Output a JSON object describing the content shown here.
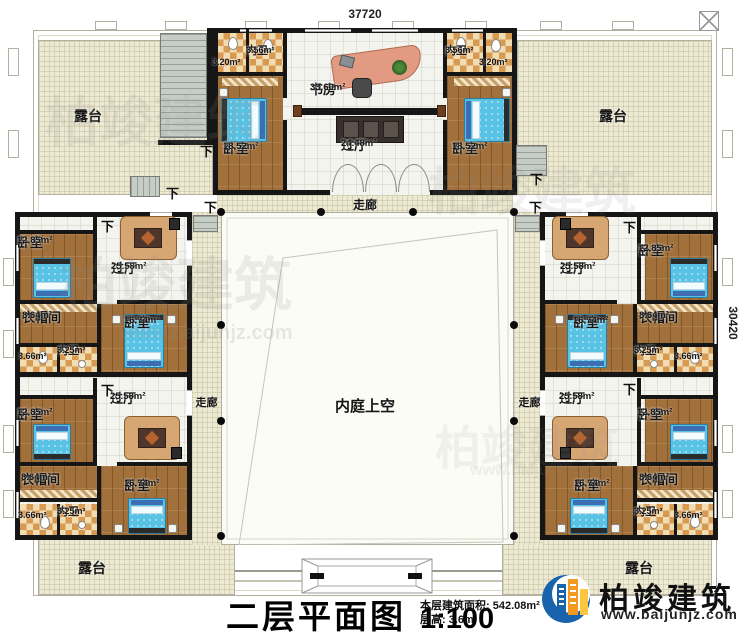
{
  "dimensions": {
    "top": "37720",
    "right": "30420"
  },
  "title": {
    "name": "二层平面图",
    "scale": "1:100",
    "area_info": "本层建筑面积: 542.08m²",
    "floor_height": "层高: 3.6m"
  },
  "logo": {
    "name": "柏竣建筑",
    "url": "www.baijunjz.com"
  },
  "watermark": {
    "text": "柏竣建筑",
    "url": "www.baijunjz.com"
  },
  "courtyard": {
    "label": "内庭上空"
  },
  "corridor": {
    "label": "走廊"
  },
  "terrace": {
    "label": "露台"
  },
  "down_label": "下",
  "top_block": {
    "study": {
      "name": "书房",
      "area": "33.60m²"
    },
    "hall": {
      "name": "过厅",
      "area": "24.48m²"
    },
    "bedroom": {
      "name": "卧室",
      "area": "18.52m²"
    },
    "bath": {
      "name": "内卫",
      "area": "3.56m²",
      "cell": "3.20m²"
    }
  },
  "wing": {
    "bedroom_small": {
      "name": "卧室",
      "area": "12.85m²"
    },
    "hall": {
      "name": "过厅",
      "area": "25.58m²"
    },
    "cloak": {
      "name": "衣帽间",
      "area": "8.64m²"
    },
    "bath": {
      "name": "内卫",
      "area": "3.25m²",
      "cell": "3.66m²"
    },
    "bedroom_large": {
      "name": "卧室",
      "area": "16.74m²"
    }
  }
}
